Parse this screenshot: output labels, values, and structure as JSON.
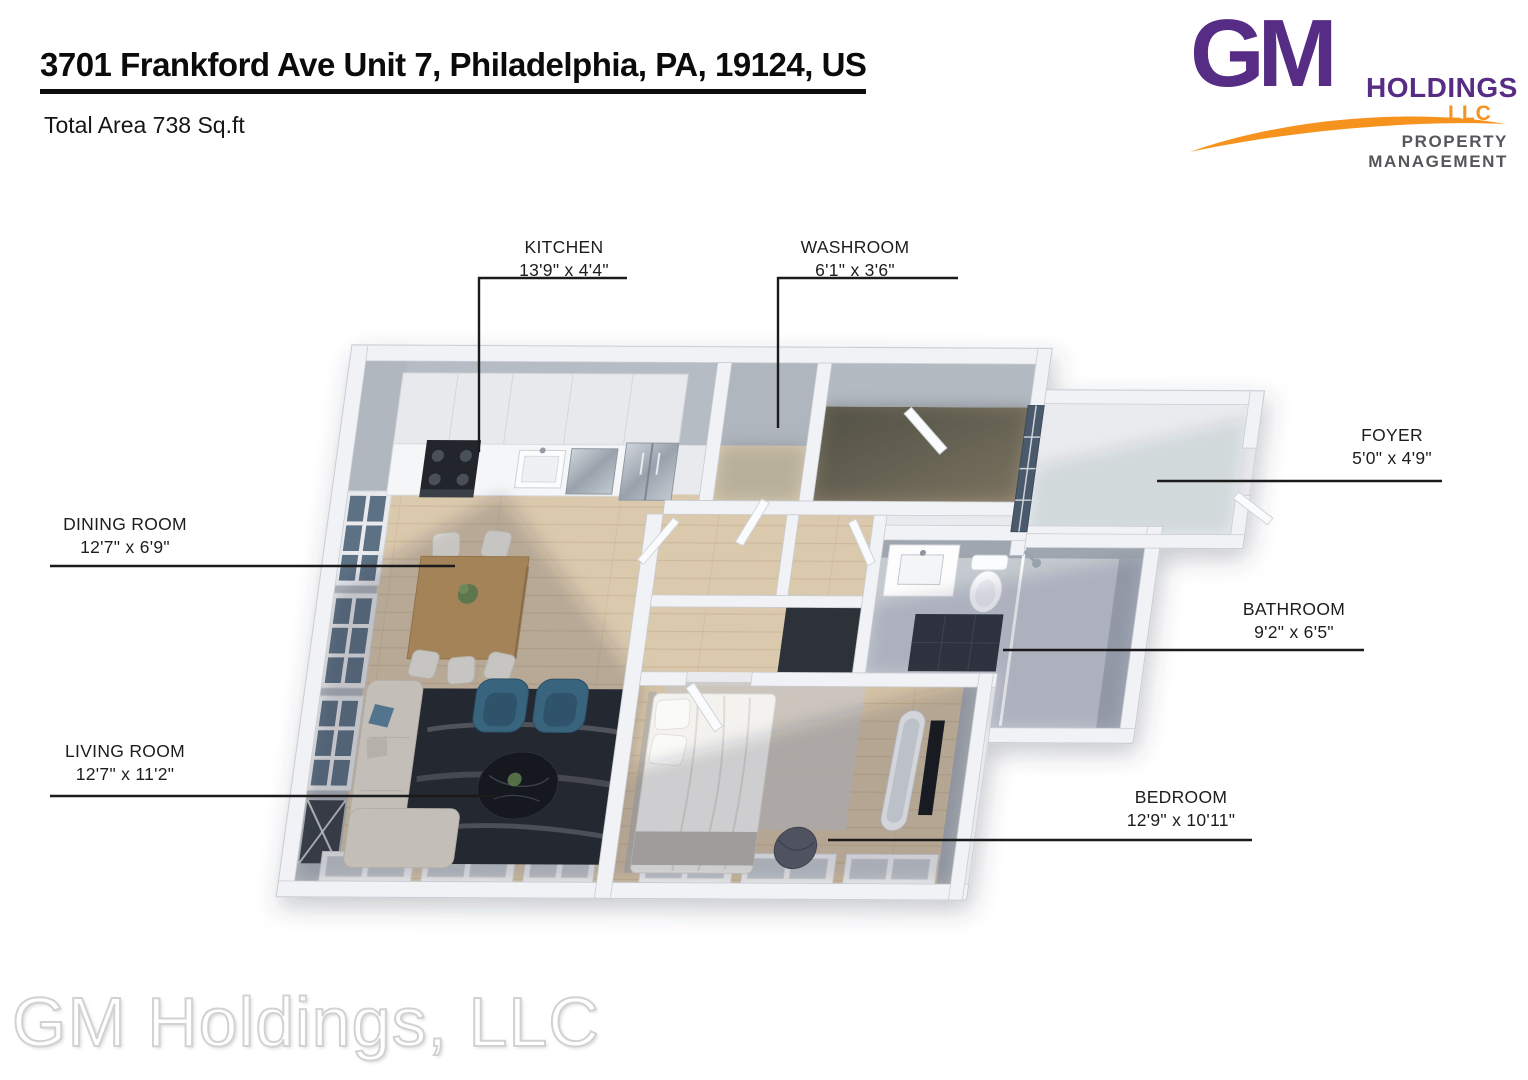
{
  "header": {
    "title": "3701 Frankford Ave Unit 7, Philadelphia, PA, 19124, US",
    "total_area": "Total Area 738 Sq.ft"
  },
  "logo": {
    "monogram": "GM",
    "name": "HOLDINGS",
    "suffix": "LLC",
    "tagline": "PROPERTY MANAGEMENT",
    "colors": {
      "purple": "#572c85",
      "orange": "#f6921e",
      "gray": "#55565a"
    }
  },
  "rooms": [
    {
      "name": "KITCHEN",
      "dims": "13'9\" x 4'4\""
    },
    {
      "name": "WASHROOM",
      "dims": "6'1\" x 3'6\""
    },
    {
      "name": "FOYER",
      "dims": "5'0\" x 4'9\""
    },
    {
      "name": "DINING ROOM",
      "dims": "12'7\" x 6'9\""
    },
    {
      "name": "BATHROOM",
      "dims": "9'2\" x 6'5\""
    },
    {
      "name": "LIVING ROOM",
      "dims": "12'7\" x 11'2\""
    },
    {
      "name": "BEDROOM",
      "dims": "12'9\" x 10'11\""
    }
  ],
  "watermark": "GM Holdings, LLC"
}
